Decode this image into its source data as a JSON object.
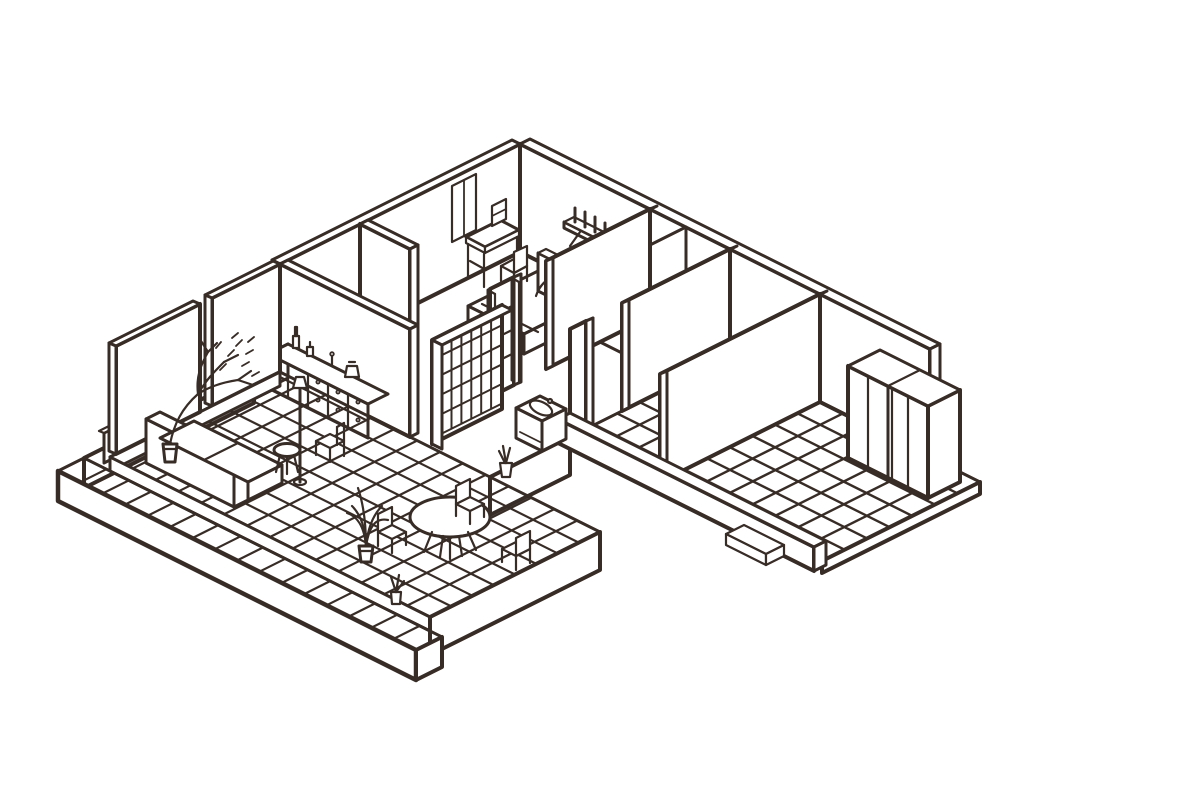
{
  "figure": {
    "kind": "isometric-floorplan-illustration",
    "description": "Hand-drawn isometric cutaway drawing of an L-shaped apartment interior, black-brown ink line art on white, no visible text",
    "style": "ink line drawing, isometric 2:1 projection, white fills, tiled floors"
  },
  "colors": {
    "ink": "#382c26",
    "paper": "#ffffff"
  },
  "scene": {
    "rooms": [
      {
        "name": "bedroom",
        "position": "top",
        "floor": "plain"
      },
      {
        "name": "hallway-bathroom",
        "position": "center",
        "floor": "plain"
      },
      {
        "name": "tiled-room-a",
        "position": "right-center",
        "floor": "tile-grid"
      },
      {
        "name": "tiled-room-b",
        "position": "far-right",
        "floor": "tile-grid"
      },
      {
        "name": "living-dining-room",
        "position": "lower-left",
        "floor": "tile-grid"
      },
      {
        "name": "veranda-deck",
        "position": "lower-left-edge",
        "floor": "planks"
      }
    ],
    "furniture": [
      "bed-with-headboard",
      "desk",
      "desk-chair",
      "wall-book-shelf",
      "ladder-shelf",
      "tiled-shower-wall",
      "vanity-basin",
      "toilet",
      "bench",
      "wardrobe-4-door",
      "front-beam",
      "step-box",
      "sideboard-with-drawers",
      "bottles",
      "vase",
      "sofa",
      "round-stool",
      "side-chair",
      "floor-lamp",
      "round-dining-table",
      "dining-chairs",
      "potted-tree",
      "potted-plants",
      "low-rail"
    ]
  },
  "grids": [
    {
      "name": "room-a-floor-tiles",
      "g": "gridRoomA",
      "origin": [
        730,
        357
      ],
      "va": [
        22.5,
        11.25
      ],
      "cols": 4,
      "vb": [
        -22.57,
        11.29
      ],
      "rows": 7,
      "w": 2.4
    },
    {
      "name": "room-b-floor-tiles",
      "g": "gridRoomB",
      "origin": [
        820,
        402
      ],
      "va": [
        22.86,
        11.43
      ],
      "cols": 7,
      "vb": [
        -22.57,
        11.29
      ],
      "rows": 7,
      "w": 2.4
    },
    {
      "name": "living-floor-tiles",
      "g": "gridLiving",
      "origin": [
        280,
        372
      ],
      "va": [
        22.857,
        11.429
      ],
      "cols": 14,
      "vb": [
        -21.25,
        10.625
      ],
      "rows": 8,
      "w": 2.2
    },
    {
      "name": "shower-wall-tiles",
      "g": "gridShower",
      "origin": [
        501,
        306
      ],
      "va": [
        -9.9,
        4.95
      ],
      "cols": 7,
      "vb": [
        0,
        19.6
      ],
      "rows": 5,
      "w": 2
    },
    {
      "name": "deck-left-planks",
      "g": "gridDeckL",
      "origin": [
        254,
        373
      ],
      "va": [
        26,
        13
      ],
      "cols": 1,
      "vb": [
        -21.25,
        10.625
      ],
      "rows": 8,
      "w": 2.2
    },
    {
      "name": "deck-front-planks",
      "g": "gridDeckF",
      "origin": [
        84,
        458
      ],
      "va": [
        22.375,
        11.19
      ],
      "cols": 16,
      "vb": [
        -26,
        13
      ],
      "rows": 1,
      "w": 2.2
    }
  ]
}
